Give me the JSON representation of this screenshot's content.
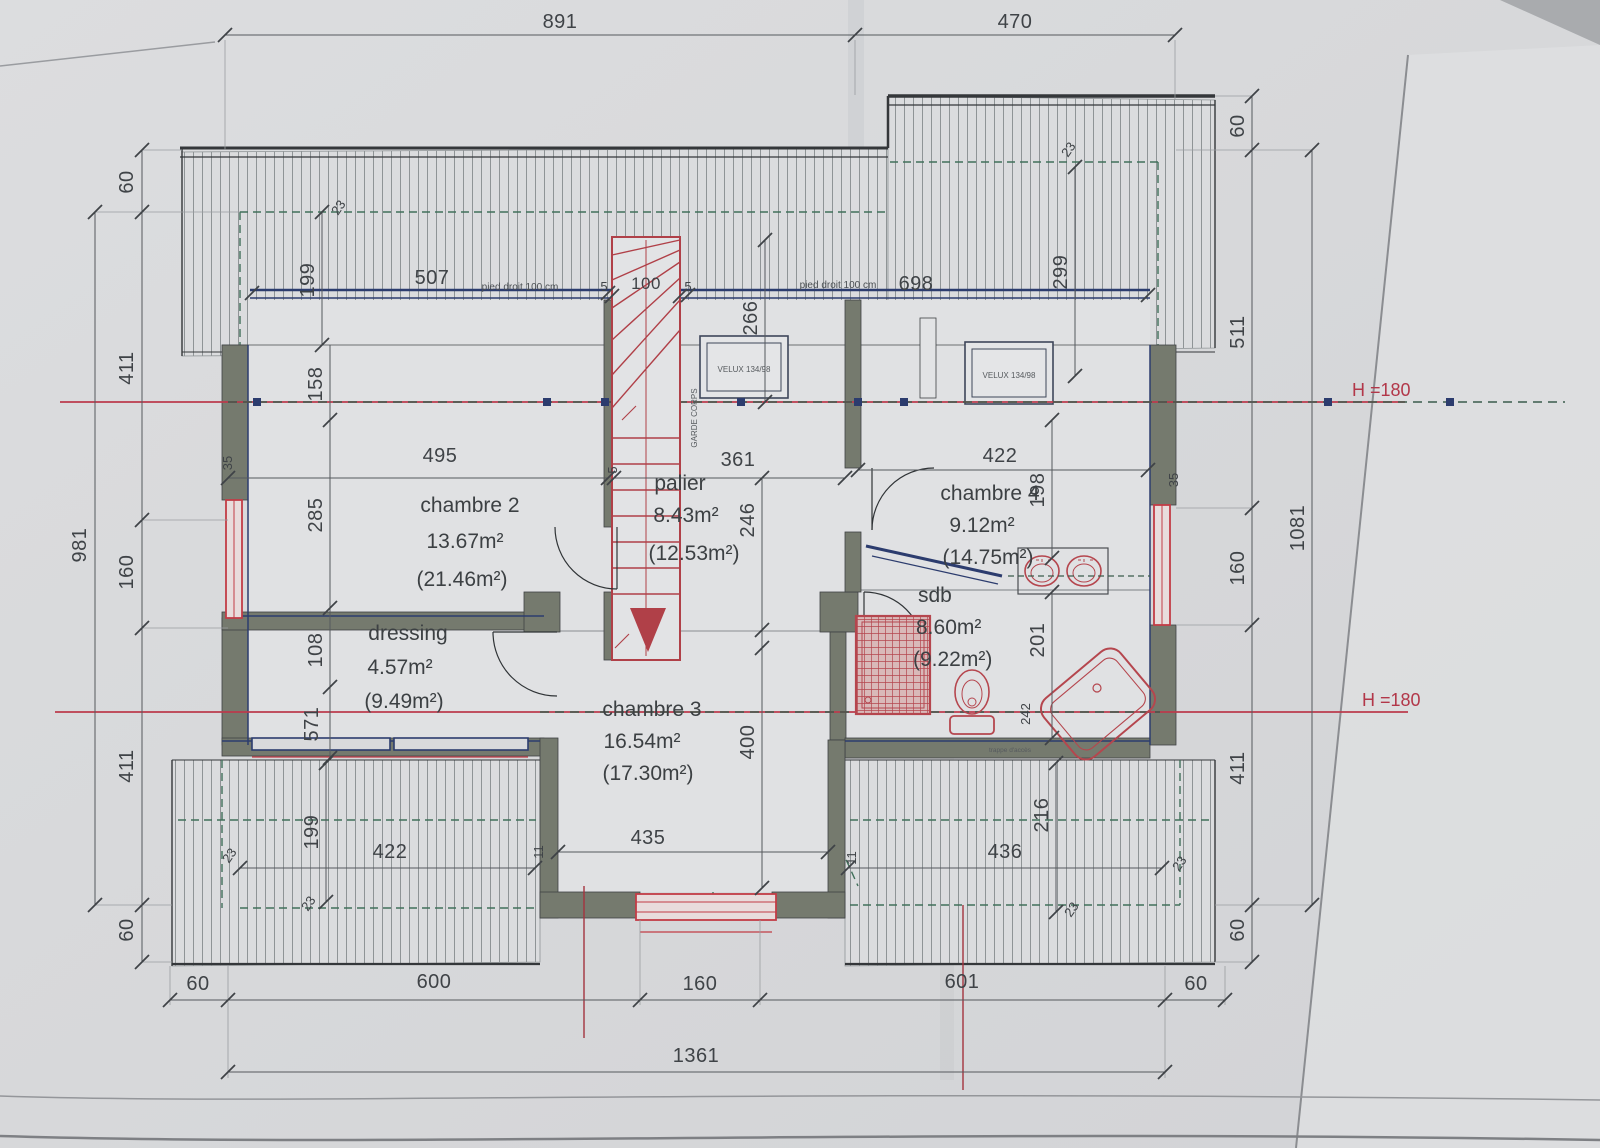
{
  "plan": {
    "rooms": {
      "chambre2": {
        "name": "chambre 2",
        "area": "13.67m²",
        "area_total": "(21.46m²)"
      },
      "palier": {
        "name": "palier",
        "area": "8.43m²",
        "area_total": "(12.53m²)"
      },
      "chambre4": {
        "name": "chambre 4",
        "area": "9.12m²",
        "area_total": "(14.75m²)"
      },
      "dressing": {
        "name": "dressing",
        "area": "4.57m²",
        "area_total": "(9.49m²)"
      },
      "chambre3": {
        "name": "chambre 3",
        "area": "16.54m²",
        "area_total": "(17.30m²)"
      },
      "sdb": {
        "name": "sdb",
        "area": "8.60m²",
        "area_total": "(9.22m²)"
      }
    },
    "annotations": {
      "height_line": "H =180",
      "knee_wall_note": "pied droit 100 cm",
      "velux": "VELUX 134/98",
      "guard_rail": "GARDE CORPS",
      "access_note": "trappe d'accès"
    },
    "dimensions": {
      "d891": "891",
      "d470": "470",
      "L60a": "60",
      "L411a": "411",
      "L160": "160",
      "L411b": "411",
      "L60b": "60",
      "L981": "981",
      "R60a": "60",
      "R511": "511",
      "R160": "160",
      "R411": "411",
      "R60b": "60",
      "R1081": "1081",
      "R299": "299",
      "R23": "23",
      "B60a": "60",
      "B600": "600",
      "B160": "160",
      "B601": "601",
      "B60b": "60",
      "B1361": "1361",
      "i23a": "23",
      "i199a": "199",
      "i158": "158",
      "i285": "285",
      "i108": "108",
      "i571": "571",
      "i199b": "199",
      "i23b": "23",
      "i23c": "23",
      "c495": "495",
      "c361": "361",
      "c246": "246",
      "c266": "266",
      "c400": "400",
      "c435": "435",
      "c422t": "422",
      "c198": "198",
      "c201": "201",
      "c242": "242",
      "c422b": "422",
      "c436": "436",
      "c216": "216",
      "c23d": "23",
      "c23e": "23",
      "k507": "507",
      "k698": "698",
      "w35L": "35",
      "w35R": "35",
      "w11a": "11",
      "w11b": "11",
      "s5a": "5",
      "s100": "100",
      "s5b": "5",
      "s5c": "5"
    }
  }
}
